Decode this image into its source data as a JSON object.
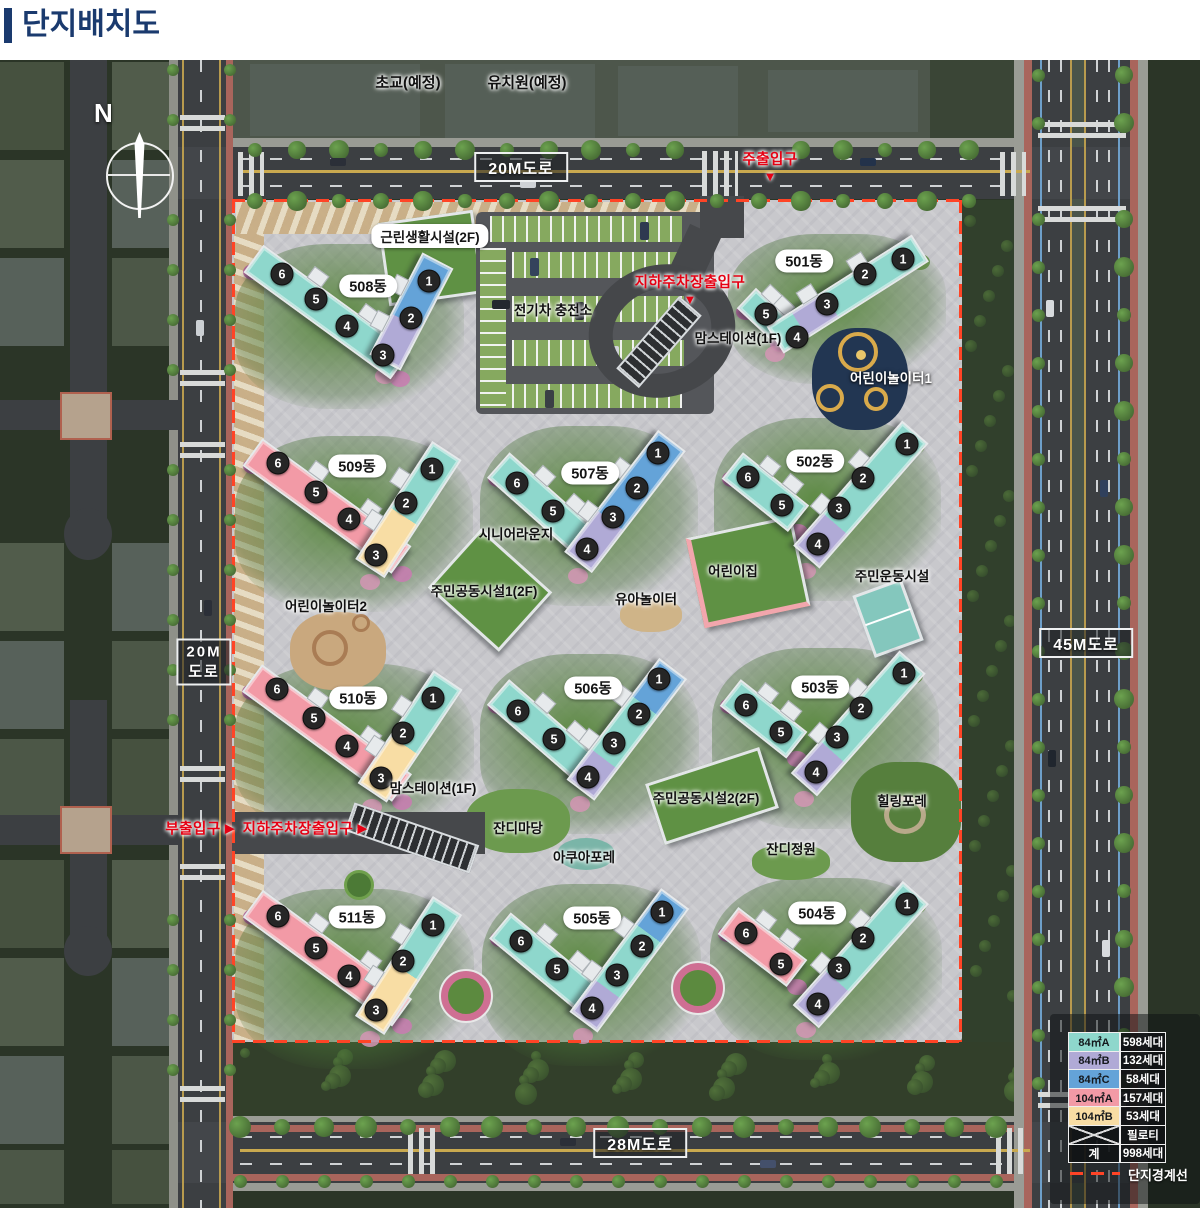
{
  "title": {
    "text": "단지배치도"
  },
  "compass": {
    "label": "N"
  },
  "context_labels": [
    {
      "label": "초교(예정)",
      "x": 408,
      "y": 82
    },
    {
      "label": "유치원(예정)",
      "x": 527,
      "y": 82
    }
  ],
  "road_labels": {
    "top": "20M도로",
    "right": "45M도로",
    "bottom": "28M도로",
    "left": [
      "20M",
      "도로"
    ]
  },
  "entrances": [
    {
      "label": "주출입구",
      "arrow": "▼",
      "x": 770,
      "y": 166,
      "dir": "down"
    },
    {
      "label": "지하주차장출입구",
      "arrow": "▼",
      "x": 690,
      "y": 289,
      "dir": "down"
    },
    {
      "label": "부출입구",
      "arrow": "▶",
      "x": 200,
      "y": 828,
      "dir": "right"
    },
    {
      "label": "지하주차장출입구",
      "arrow": "▶",
      "x": 305,
      "y": 828,
      "dir": "right"
    }
  ],
  "facilities": [
    {
      "label": "근린생활시설(2F)",
      "x": 430,
      "y": 236,
      "style": "pill"
    },
    {
      "label": "전기차 충전소",
      "x": 553,
      "y": 309,
      "style": "dark"
    },
    {
      "label": "맘스테이션(1F)",
      "x": 738,
      "y": 337,
      "style": "dark"
    },
    {
      "label": "어린이놀이터1",
      "x": 891,
      "y": 377,
      "style": "light"
    },
    {
      "label": "시니어라운지",
      "x": 516,
      "y": 533,
      "style": "dark"
    },
    {
      "label": "주민공동시설1(2F)",
      "x": 484,
      "y": 590,
      "style": "dark"
    },
    {
      "label": "유아놀이터",
      "x": 646,
      "y": 598,
      "style": "dark"
    },
    {
      "label": "어린이놀이터2",
      "x": 326,
      "y": 605,
      "style": "dark"
    },
    {
      "label": "어린이집",
      "x": 733,
      "y": 570,
      "style": "dark"
    },
    {
      "label": "주민운동시설",
      "x": 892,
      "y": 575,
      "style": "dark"
    },
    {
      "label": "맘스테이션(1F)",
      "x": 433,
      "y": 787,
      "style": "dark"
    },
    {
      "label": "잔디마당",
      "x": 518,
      "y": 827,
      "style": "dark"
    },
    {
      "label": "아쿠아포레",
      "x": 584,
      "y": 856,
      "style": "dark"
    },
    {
      "label": "주민공동시설2(2F)",
      "x": 706,
      "y": 797,
      "style": "dark"
    },
    {
      "label": "잔디정원",
      "x": 791,
      "y": 848,
      "style": "dark"
    },
    {
      "label": "힐링포레",
      "x": 902,
      "y": 800,
      "style": "dark"
    }
  ],
  "buildings": [
    {
      "label": "508동",
      "lx": 368,
      "ly": 286,
      "arms": [
        {
          "x1": 253,
          "y1": 258,
          "x2": 400,
          "y2": 365,
          "w": 34,
          "seg": [
            [
              "teal",
              100
            ]
          ]
        },
        {
          "x1": 438,
          "y1": 260,
          "x2": 385,
          "y2": 362,
          "w": 35,
          "seg": [
            [
              "blue",
              60
            ],
            [
              "purple",
              40
            ]
          ]
        }
      ],
      "units": [
        {
          "n": "6",
          "x": 282,
          "y": 274
        },
        {
          "n": "5",
          "x": 316,
          "y": 299
        },
        {
          "n": "4",
          "x": 347,
          "y": 326
        },
        {
          "n": "1",
          "x": 429,
          "y": 281
        },
        {
          "n": "2",
          "x": 411,
          "y": 318
        },
        {
          "n": "3",
          "x": 383,
          "y": 355
        }
      ]
    },
    {
      "label": "501동",
      "lx": 804,
      "ly": 261,
      "arms": [
        {
          "x1": 746,
          "y1": 298,
          "x2": 780,
          "y2": 330,
          "w": 28,
          "seg": [
            [
              "teal",
              100
            ]
          ]
        },
        {
          "x1": 920,
          "y1": 248,
          "x2": 775,
          "y2": 340,
          "w": 32,
          "seg": [
            [
              "teal",
              62
            ],
            [
              "purple",
              22
            ],
            [
              "teal",
              16
            ]
          ]
        }
      ],
      "units": [
        {
          "n": "1",
          "x": 903,
          "y": 259
        },
        {
          "n": "2",
          "x": 865,
          "y": 274
        },
        {
          "n": "3",
          "x": 827,
          "y": 304
        },
        {
          "n": "4",
          "x": 797,
          "y": 337
        },
        {
          "n": "5",
          "x": 766,
          "y": 314
        }
      ]
    },
    {
      "label": "509동",
      "lx": 357,
      "ly": 466,
      "arms": [
        {
          "x1": 253,
          "y1": 452,
          "x2": 402,
          "y2": 560,
          "w": 34,
          "seg": [
            [
              "pink",
              100
            ]
          ]
        },
        {
          "x1": 447,
          "y1": 450,
          "x2": 370,
          "y2": 568,
          "w": 35,
          "seg": [
            [
              "teal",
              56
            ],
            [
              "yellow",
              44
            ]
          ]
        }
      ],
      "units": [
        {
          "n": "6",
          "x": 278,
          "y": 463
        },
        {
          "n": "5",
          "x": 316,
          "y": 492
        },
        {
          "n": "4",
          "x": 349,
          "y": 519
        },
        {
          "n": "1",
          "x": 432,
          "y": 469
        },
        {
          "n": "2",
          "x": 406,
          "y": 503
        },
        {
          "n": "3",
          "x": 376,
          "y": 555
        }
      ]
    },
    {
      "label": "507동",
      "lx": 590,
      "ly": 473,
      "arms": [
        {
          "x1": 498,
          "y1": 465,
          "x2": 588,
          "y2": 545,
          "w": 34,
          "seg": [
            [
              "teal",
              100
            ]
          ]
        },
        {
          "x1": 672,
          "y1": 440,
          "x2": 578,
          "y2": 562,
          "w": 35,
          "seg": [
            [
              "blue",
              66
            ],
            [
              "purple",
              34
            ]
          ]
        }
      ],
      "units": [
        {
          "n": "6",
          "x": 517,
          "y": 483
        },
        {
          "n": "5",
          "x": 553,
          "y": 511
        },
        {
          "n": "1",
          "x": 658,
          "y": 453
        },
        {
          "n": "2",
          "x": 637,
          "y": 488
        },
        {
          "n": "3",
          "x": 613,
          "y": 517
        },
        {
          "n": "4",
          "x": 587,
          "y": 549
        }
      ]
    },
    {
      "label": "502동",
      "lx": 815,
      "ly": 461,
      "arms": [
        {
          "x1": 732,
          "y1": 465,
          "x2": 798,
          "y2": 518,
          "w": 34,
          "seg": [
            [
              "teal",
              100
            ]
          ]
        },
        {
          "x1": 915,
          "y1": 432,
          "x2": 806,
          "y2": 557,
          "w": 35,
          "seg": [
            [
              "teal",
              74
            ],
            [
              "purple",
              26
            ]
          ]
        }
      ],
      "units": [
        {
          "n": "6",
          "x": 748,
          "y": 477
        },
        {
          "n": "5",
          "x": 782,
          "y": 505
        },
        {
          "n": "1",
          "x": 907,
          "y": 444
        },
        {
          "n": "2",
          "x": 863,
          "y": 478
        },
        {
          "n": "3",
          "x": 839,
          "y": 508
        },
        {
          "n": "4",
          "x": 818,
          "y": 544
        }
      ]
    },
    {
      "label": "510동",
      "lx": 358,
      "ly": 698,
      "arms": [
        {
          "x1": 252,
          "y1": 678,
          "x2": 402,
          "y2": 788,
          "w": 34,
          "seg": [
            [
              "pink",
              100
            ]
          ]
        },
        {
          "x1": 448,
          "y1": 680,
          "x2": 372,
          "y2": 793,
          "w": 35,
          "seg": [
            [
              "teal",
              58
            ],
            [
              "yellow",
              42
            ]
          ]
        }
      ],
      "units": [
        {
          "n": "6",
          "x": 277,
          "y": 689
        },
        {
          "n": "5",
          "x": 314,
          "y": 718
        },
        {
          "n": "4",
          "x": 347,
          "y": 746
        },
        {
          "n": "1",
          "x": 433,
          "y": 698
        },
        {
          "n": "2",
          "x": 403,
          "y": 733
        },
        {
          "n": "3",
          "x": 381,
          "y": 778
        }
      ]
    },
    {
      "label": "506동",
      "lx": 593,
      "ly": 688,
      "arms": [
        {
          "x1": 498,
          "y1": 692,
          "x2": 590,
          "y2": 772,
          "w": 34,
          "seg": [
            [
              "teal",
              100
            ]
          ]
        },
        {
          "x1": 673,
          "y1": 668,
          "x2": 580,
          "y2": 790,
          "w": 35,
          "seg": [
            [
              "blue",
              30
            ],
            [
              "teal",
              45
            ],
            [
              "purple",
              25
            ]
          ]
        }
      ],
      "units": [
        {
          "n": "6",
          "x": 518,
          "y": 711
        },
        {
          "n": "5",
          "x": 554,
          "y": 739
        },
        {
          "n": "1",
          "x": 659,
          "y": 679
        },
        {
          "n": "2",
          "x": 639,
          "y": 714
        },
        {
          "n": "3",
          "x": 614,
          "y": 743
        },
        {
          "n": "4",
          "x": 588,
          "y": 777
        }
      ]
    },
    {
      "label": "503동",
      "lx": 820,
      "ly": 687,
      "arms": [
        {
          "x1": 730,
          "y1": 692,
          "x2": 797,
          "y2": 745,
          "w": 34,
          "seg": [
            [
              "teal",
              100
            ]
          ]
        },
        {
          "x1": 913,
          "y1": 662,
          "x2": 804,
          "y2": 785,
          "w": 35,
          "seg": [
            [
              "teal",
              74
            ],
            [
              "purple",
              26
            ]
          ]
        }
      ],
      "units": [
        {
          "n": "6",
          "x": 746,
          "y": 705
        },
        {
          "n": "5",
          "x": 781,
          "y": 732
        },
        {
          "n": "1",
          "x": 904,
          "y": 673
        },
        {
          "n": "2",
          "x": 861,
          "y": 708
        },
        {
          "n": "3",
          "x": 837,
          "y": 737
        },
        {
          "n": "4",
          "x": 816,
          "y": 772
        }
      ]
    },
    {
      "label": "511동",
      "lx": 357,
      "ly": 917,
      "arms": [
        {
          "x1": 253,
          "y1": 903,
          "x2": 402,
          "y2": 1012,
          "w": 34,
          "seg": [
            [
              "pink",
              100
            ]
          ]
        },
        {
          "x1": 448,
          "y1": 905,
          "x2": 370,
          "y2": 1025,
          "w": 35,
          "seg": [
            [
              "teal",
              55
            ],
            [
              "yellow",
              45
            ]
          ]
        }
      ],
      "units": [
        {
          "n": "6",
          "x": 278,
          "y": 916
        },
        {
          "n": "5",
          "x": 316,
          "y": 948
        },
        {
          "n": "4",
          "x": 349,
          "y": 976
        },
        {
          "n": "1",
          "x": 433,
          "y": 925
        },
        {
          "n": "2",
          "x": 403,
          "y": 961
        },
        {
          "n": "3",
          "x": 376,
          "y": 1010
        }
      ]
    },
    {
      "label": "505동",
      "lx": 592,
      "ly": 918,
      "arms": [
        {
          "x1": 500,
          "y1": 925,
          "x2": 593,
          "y2": 1002,
          "w": 34,
          "seg": [
            [
              "teal",
              100
            ]
          ]
        },
        {
          "x1": 675,
          "y1": 898,
          "x2": 583,
          "y2": 1022,
          "w": 35,
          "seg": [
            [
              "blue",
              28
            ],
            [
              "teal",
              46
            ],
            [
              "purple",
              26
            ]
          ]
        }
      ],
      "units": [
        {
          "n": "6",
          "x": 521,
          "y": 941
        },
        {
          "n": "5",
          "x": 557,
          "y": 969
        },
        {
          "n": "1",
          "x": 662,
          "y": 912
        },
        {
          "n": "2",
          "x": 642,
          "y": 946
        },
        {
          "n": "3",
          "x": 617,
          "y": 975
        },
        {
          "n": "4",
          "x": 592,
          "y": 1008
        }
      ]
    },
    {
      "label": "504동",
      "lx": 817,
      "ly": 913,
      "arms": [
        {
          "x1": 728,
          "y1": 920,
          "x2": 797,
          "y2": 973,
          "w": 34,
          "seg": [
            [
              "pink",
              100
            ]
          ]
        },
        {
          "x1": 916,
          "y1": 892,
          "x2": 806,
          "y2": 1016,
          "w": 35,
          "seg": [
            [
              "teal",
              72
            ],
            [
              "purple",
              28
            ]
          ]
        }
      ],
      "units": [
        {
          "n": "6",
          "x": 746,
          "y": 933
        },
        {
          "n": "5",
          "x": 781,
          "y": 964
        },
        {
          "n": "1",
          "x": 907,
          "y": 904
        },
        {
          "n": "2",
          "x": 863,
          "y": 938
        },
        {
          "n": "3",
          "x": 839,
          "y": 968
        },
        {
          "n": "4",
          "x": 818,
          "y": 1004
        }
      ]
    }
  ],
  "legend": {
    "rows": [
      {
        "label": "84㎡A",
        "value": "598세대",
        "color_key": "teal"
      },
      {
        "label": "84㎡B",
        "value": "132세대",
        "color_key": "purple"
      },
      {
        "label": "84㎡C",
        "value": "58세대",
        "color_key": "blue"
      },
      {
        "label": "104㎡A",
        "value": "157세대",
        "color_key": "pink"
      },
      {
        "label": "104㎡B",
        "value": "53세대",
        "color_key": "yellow"
      },
      {
        "label": "",
        "value": "필로티",
        "color_key": "pilotis"
      },
      {
        "label": "계",
        "value": "998세대",
        "color_key": "total"
      }
    ],
    "boundary_label": "단지경계선"
  },
  "colors": {
    "teal": "#8ed7cc",
    "blue": "#64a3d8",
    "purple": "#b0aad6",
    "pink": "#f29aa6",
    "yellow": "#f8dda4",
    "entrance_red": "#e60013",
    "boundary_red": "#ff4426",
    "title_blue": "#1a3a6e"
  }
}
